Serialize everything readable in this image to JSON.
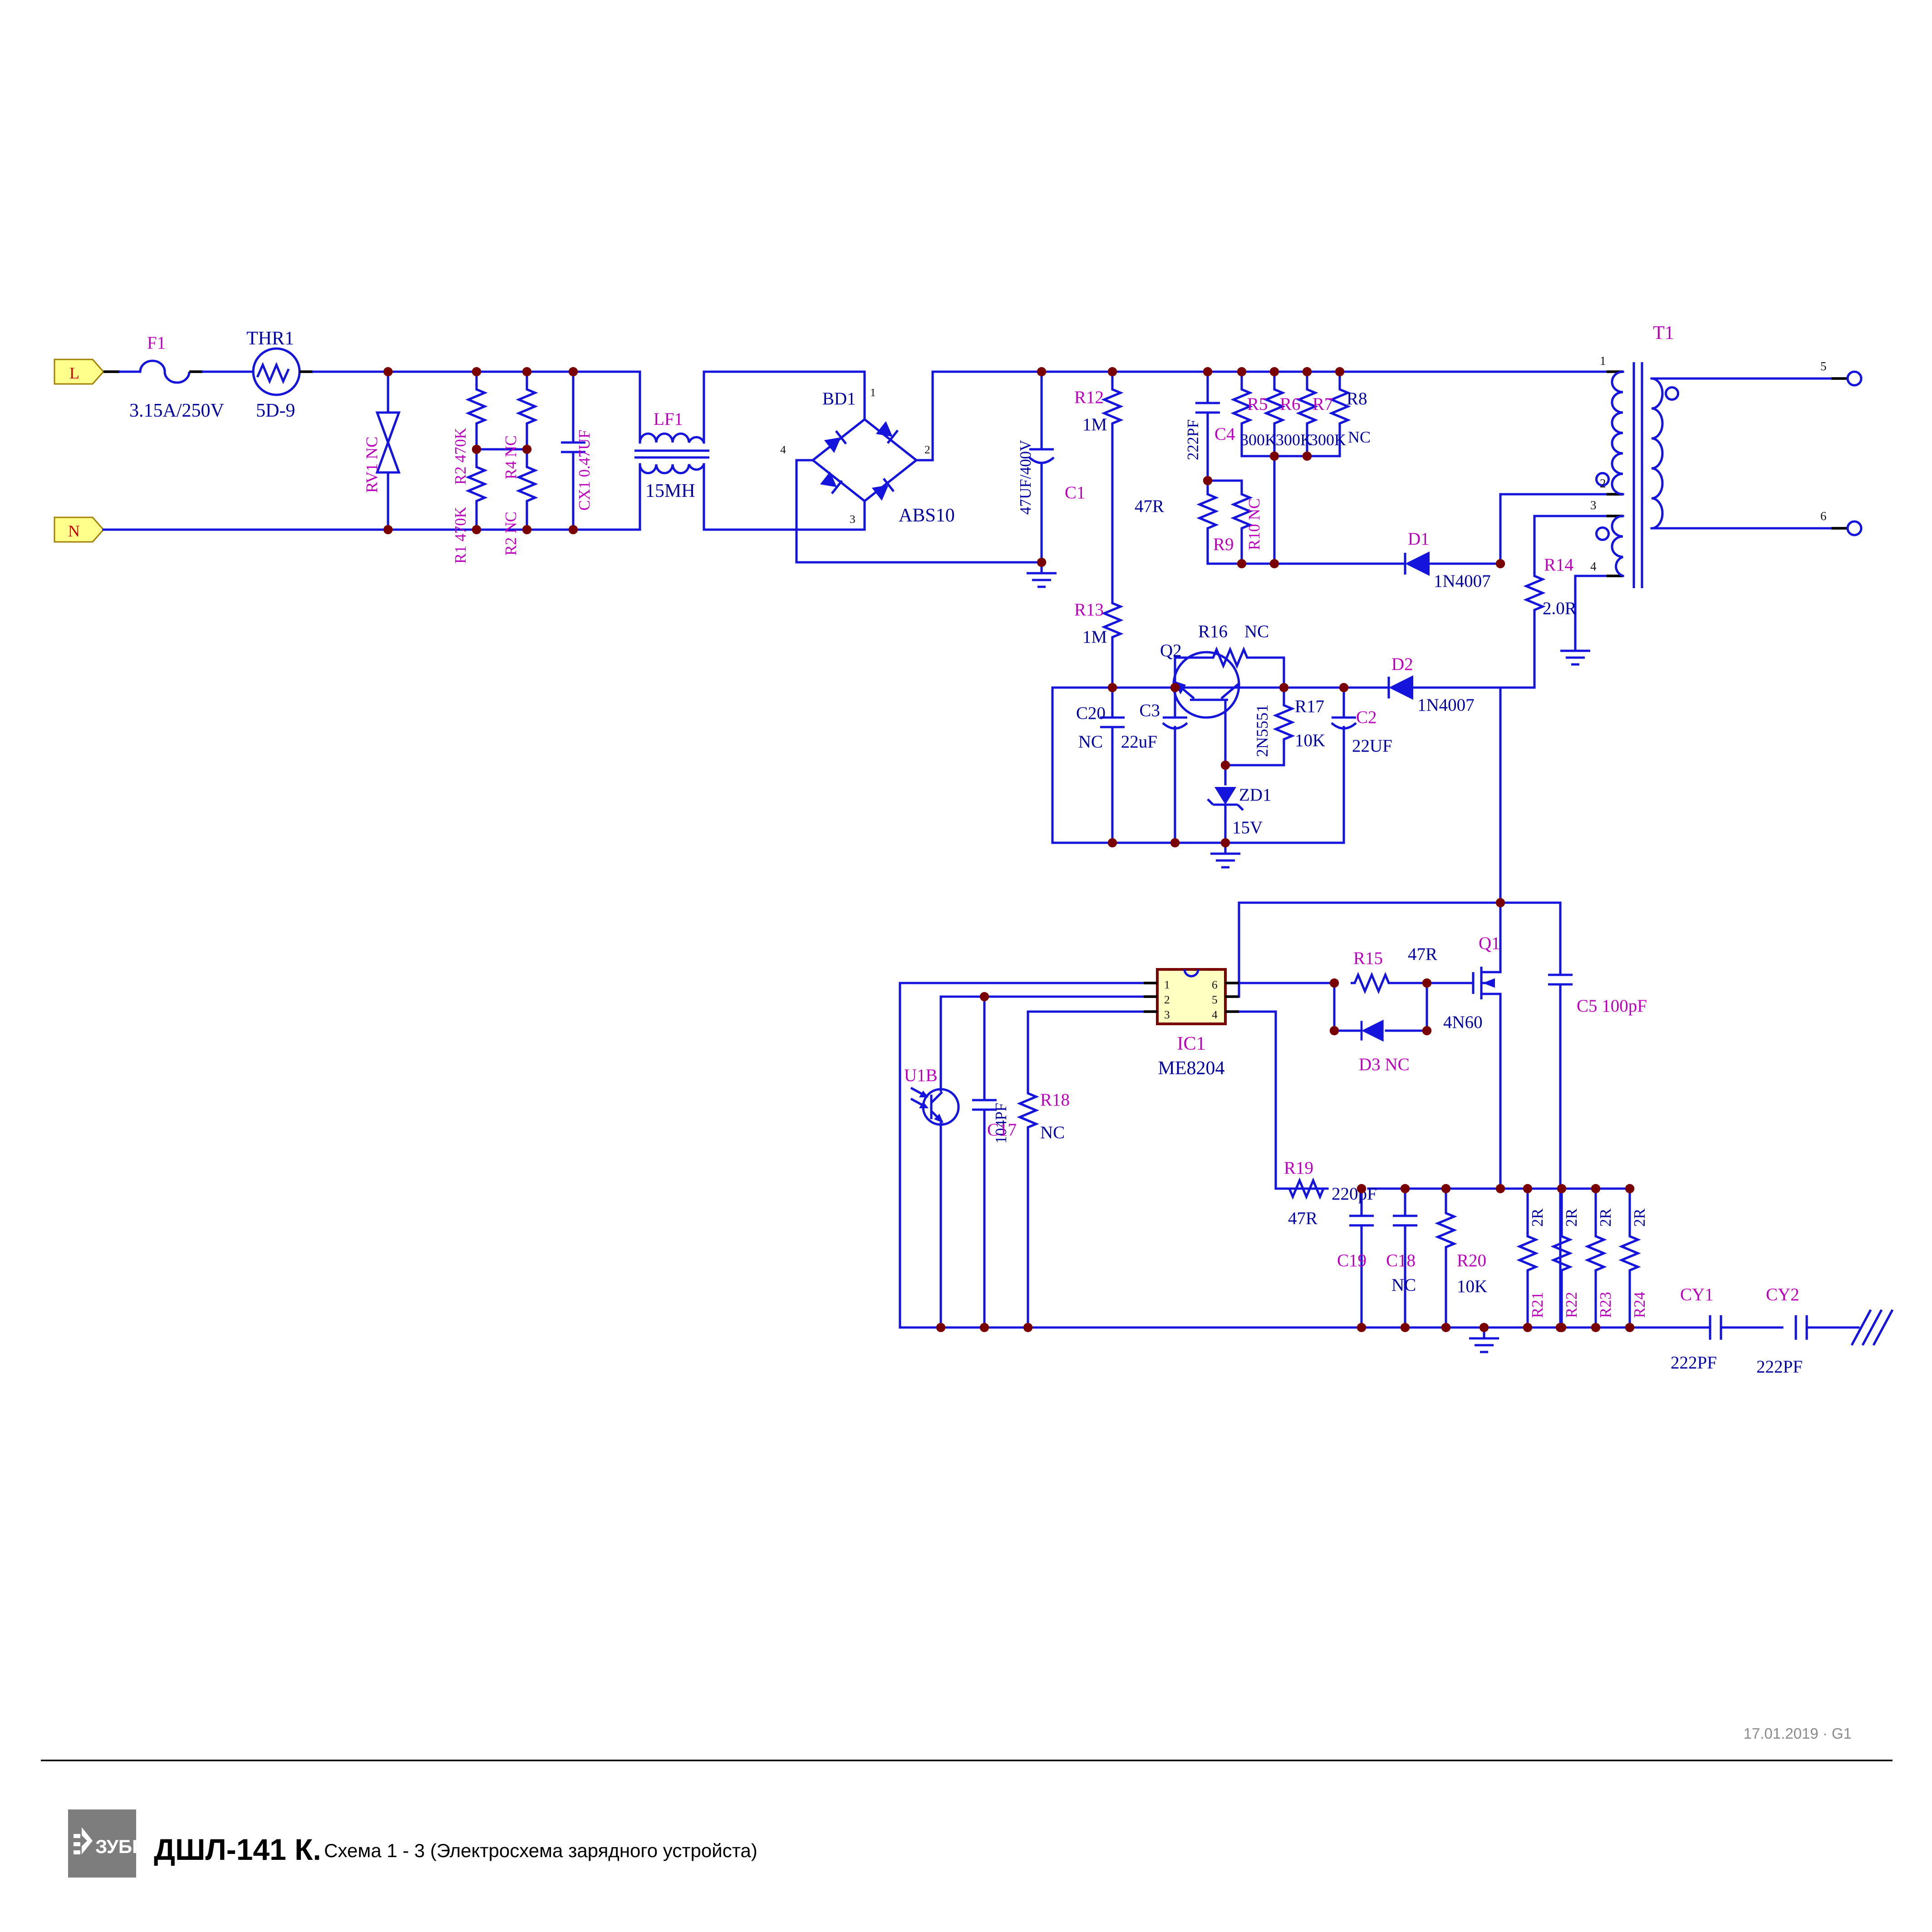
{
  "schematic": {
    "terminals": {
      "line": "L",
      "neutral": "N"
    },
    "labels": {
      "f1": "F1",
      "f1v": "3.15A/250V",
      "thr1": "THR1",
      "thr1v": "5D-9",
      "rv1": "RV1 NC",
      "r2a": "R2 470K",
      "r1": "R1 470K",
      "r4": "R4 NC",
      "r2b": "R2 NC",
      "cx1": "CX1 0.47UF",
      "lf1": "LF1",
      "lf1v": "15MH",
      "bd1": "BD1",
      "bd1v": "ABS10",
      "c1": "C1",
      "c1v": "47UF/400V",
      "r12": "R12",
      "r12v": "1M",
      "r13": "R13",
      "r13v": "1M",
      "c4": "C4",
      "c4v": "222PF",
      "r5": "R5",
      "r5v": "300K",
      "r6": "R6",
      "r6v": "300K",
      "r7": "R7",
      "r7v": "300K",
      "r8": "R8",
      "r8v": "NC",
      "r9": "R9",
      "r9v": "47R",
      "r10": "R10 NC",
      "d1": "D1",
      "d1v": "1N4007",
      "d2": "D2",
      "d2v": "1N4007",
      "t1": "T1",
      "r14": "R14",
      "r14v": "2.0R",
      "r16": "R16",
      "r16v": "NC",
      "q2": "Q2",
      "q2v": "2N5551",
      "r17": "R17",
      "r17v": "10K",
      "c3": "C3",
      "c3v": "22uF",
      "c20": "C20",
      "c20v": "NC",
      "c2": "C2",
      "c2v": "22UF",
      "zd1": "ZD1",
      "zd1v": "15V",
      "ic1": "IC1",
      "ic1v": "ME8204",
      "r15": "R15",
      "r15v": "47R",
      "d3": "D3 NC",
      "q1": "Q1",
      "q1v": "4N60",
      "c5": "C5 100pF",
      "r19": "R19",
      "r19v": "47R",
      "u1b": "U1B",
      "c17": "C17",
      "c17v": "104PF",
      "r18": "R18",
      "r18v": "NC",
      "c19": "C19",
      "c19v": "220pF",
      "c18": "C18",
      "c18v": "NC",
      "r20": "R20",
      "r20v": "10K",
      "r21": "R21",
      "r22": "R22",
      "r23": "R23",
      "r24": "R24",
      "r2x": "2R",
      "cy1": "CY1",
      "cy1v": "222PF",
      "cy2": "CY2",
      "cy2v": "222PF"
    },
    "pins": {
      "bd1": [
        "1",
        "2",
        "3",
        "4"
      ],
      "t1": [
        "1",
        "2",
        "3",
        "4",
        "5",
        "6"
      ],
      "ic1": [
        "1",
        "2",
        "3",
        "4",
        "5",
        "6"
      ]
    },
    "colors": {
      "wire": "#1414dd",
      "junction": "#7a0000",
      "ref": "#bb00bb",
      "value": "#0000a0",
      "terminal_fill": "#ffff8c",
      "ic_fill": "#ffffc2",
      "ic_border": "#7a0000"
    },
    "footer": {
      "logo": "ЗУБР",
      "model": "ДШЛ-141 К.",
      "subtitle": "Схема 1 - 3 (Электросхема зарядного устройста)",
      "date_rev": "17.01.2019 · G1"
    }
  }
}
